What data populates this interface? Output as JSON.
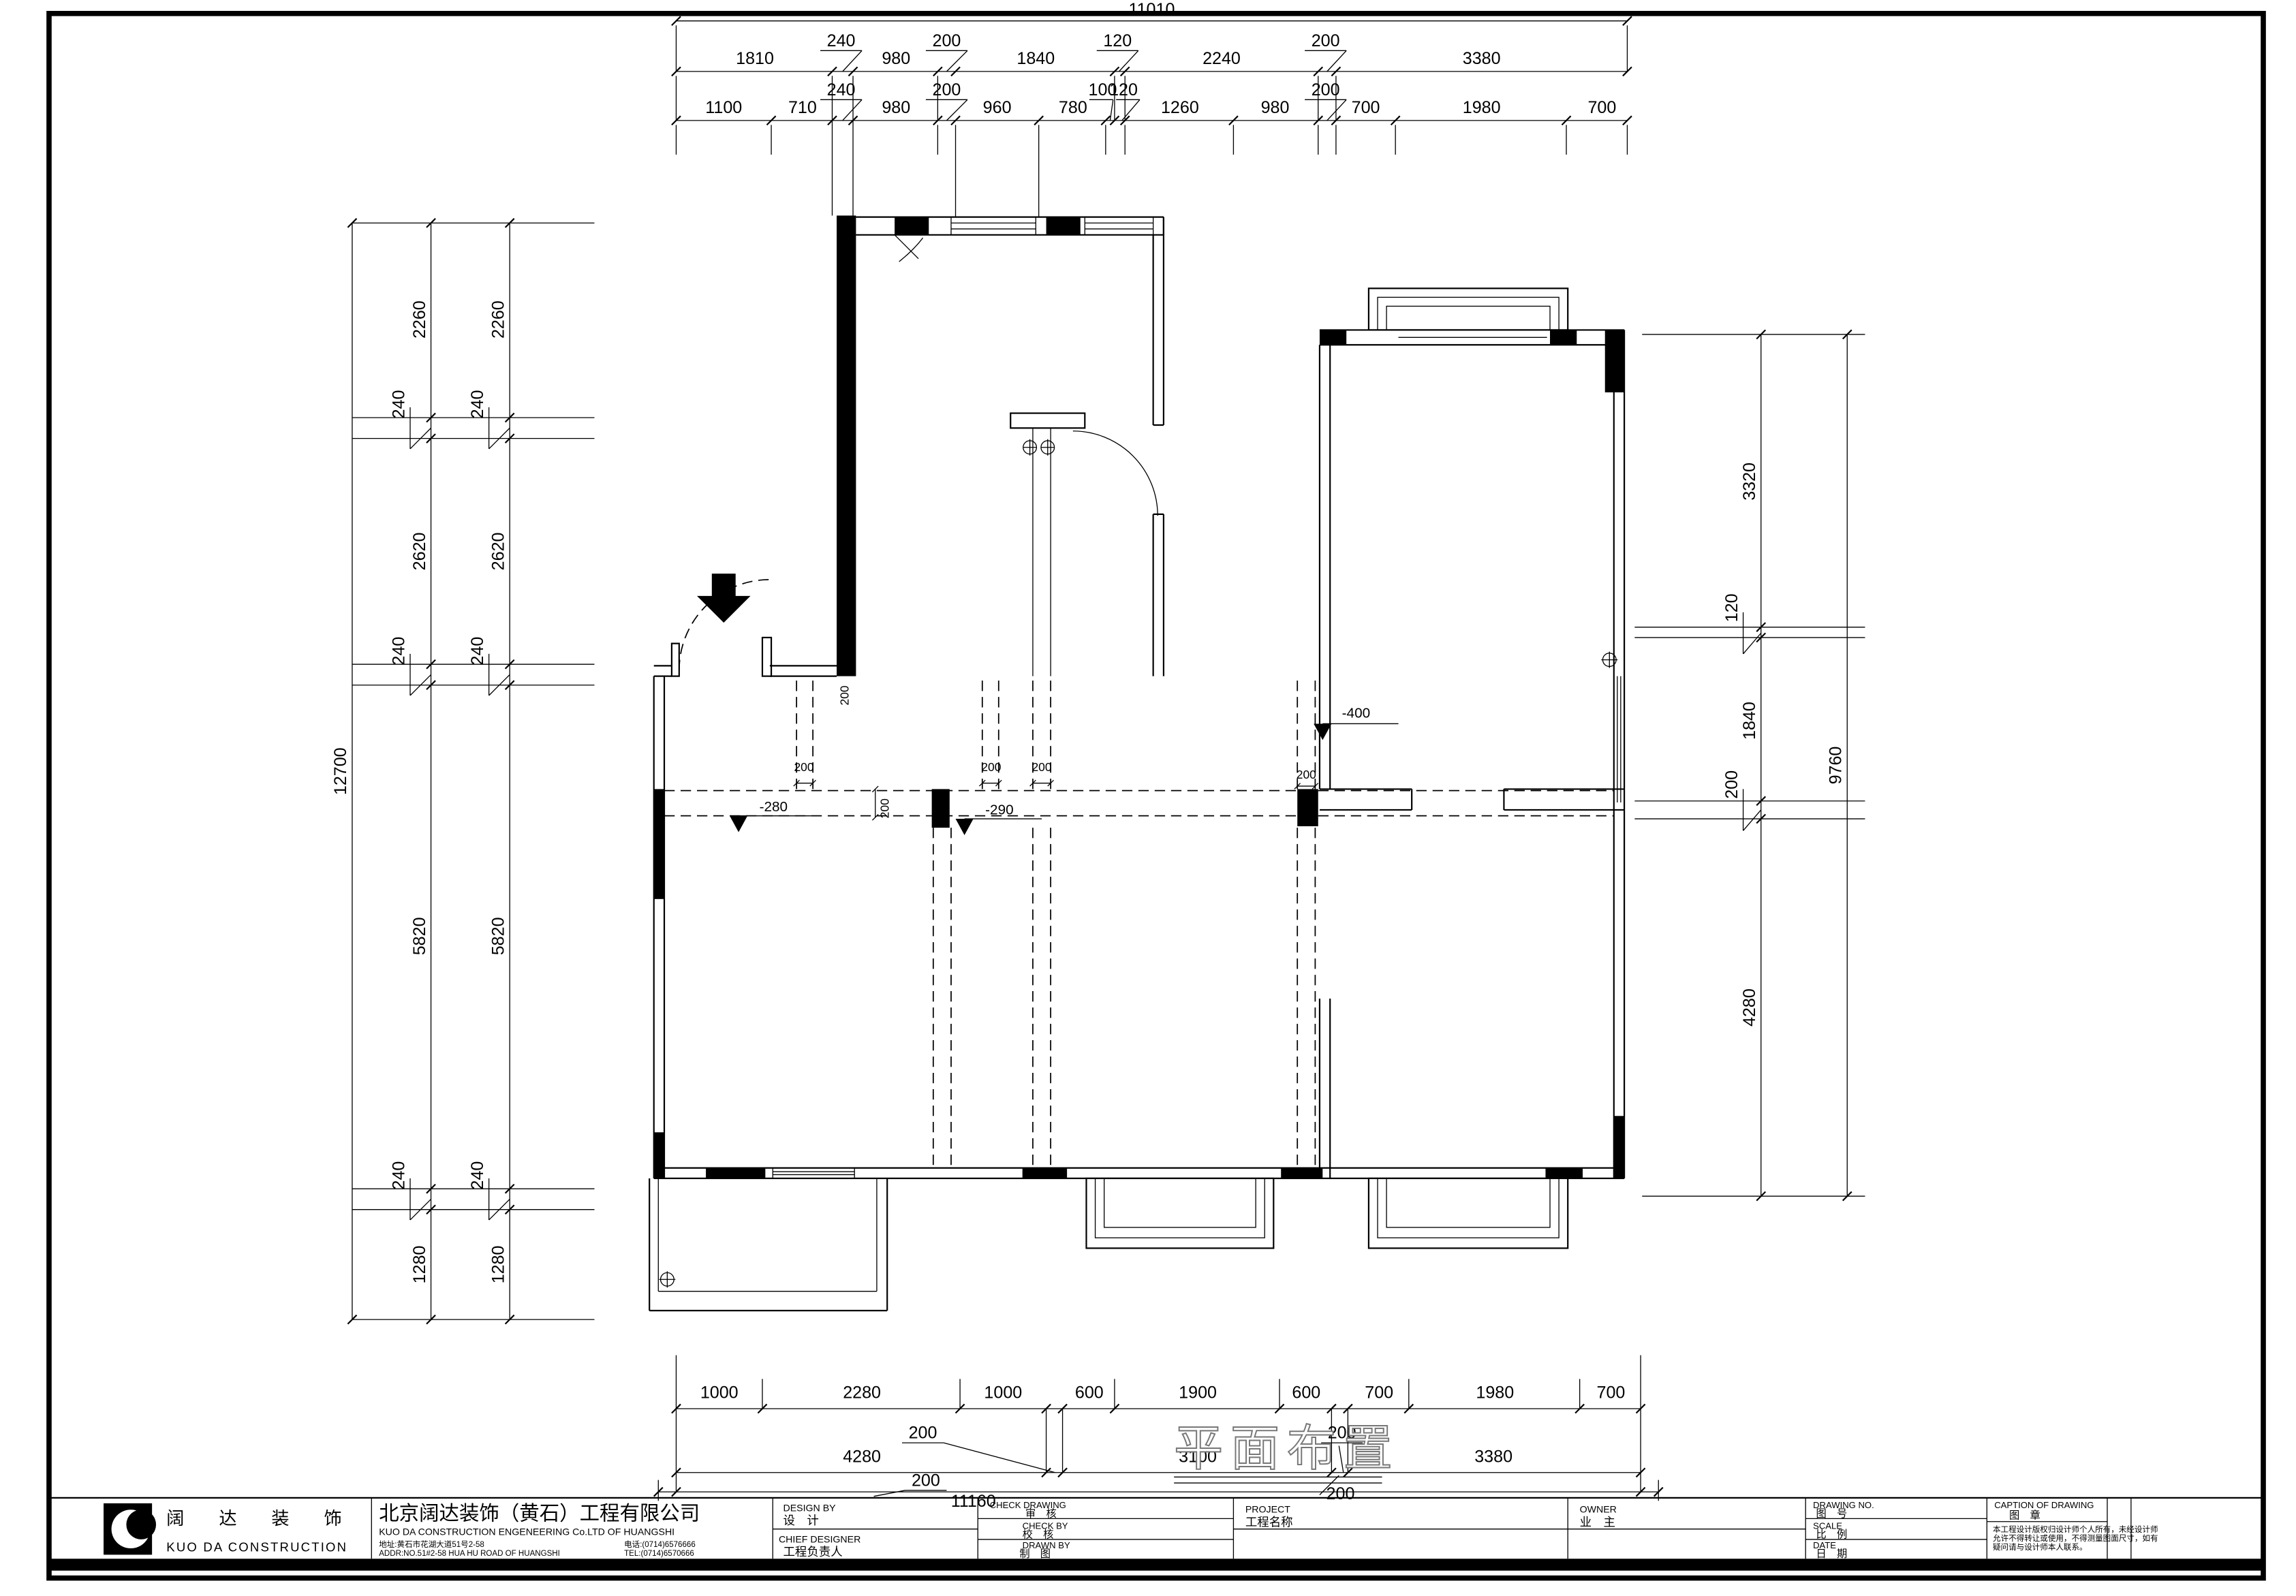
{
  "dims": {
    "top": {
      "total": "11010",
      "row1": [
        "1810",
        "240",
        "980",
        "200",
        "1840",
        "120",
        "2240",
        "200",
        "3380"
      ],
      "row2": [
        "1100",
        "710",
        "240",
        "980",
        "200",
        "960",
        "780",
        "100",
        "120",
        "1260",
        "980",
        "200",
        "700",
        "1980",
        "700"
      ]
    },
    "left": {
      "total": "12700",
      "inner": [
        "2260",
        "240",
        "2620",
        "240",
        "5820",
        "240",
        "1280"
      ],
      "outer": [
        "2260",
        "240",
        "2620",
        "240",
        "5820",
        "240",
        "1280"
      ]
    },
    "right": {
      "total": "9760",
      "segments": [
        "3320",
        "120",
        "1840",
        "200",
        "4280"
      ]
    },
    "bottom": {
      "row1": [
        "1000",
        "2280",
        "1000",
        "600",
        "1900",
        "600",
        "700",
        "1980",
        "700"
      ],
      "row2": [
        "4280",
        "200",
        "3100",
        "200",
        "3380"
      ],
      "row3": [
        "200",
        "11160",
        "200"
      ]
    }
  },
  "plan": {
    "caption": "平面布置",
    "levels": [
      "-280",
      "-290",
      "-400"
    ],
    "small_dims": [
      "200",
      "200",
      "200",
      "200",
      "200",
      "200"
    ]
  },
  "title_block": {
    "brand": {
      "name_cn": "阔  达  装  饰",
      "name_en": "KUO DA CONSTRUCTION"
    },
    "company": {
      "name": "北京阔达装饰（黄石）工程有限公司",
      "name_en": "KUO DA CONSTRUCTION ENGENEERING Co.LTD OF HUANGSHI",
      "address_cn": "地址:黄石市花湖大道51号2-58",
      "phone_cn": "电话:(0714)6576666",
      "address_en": "ADDR:NO.51#2-58 HUA HU ROAD OF HUANGSHI",
      "phone_en": "TEL:(0714)6570666"
    },
    "fields": {
      "design_by_en": "DESIGN BY",
      "design_by_cn": "设　计",
      "chief_designer_en": "CHIEF DESIGNER",
      "chief_designer_cn": "工程负责人",
      "check_drawing_en": "CHECK DRAWING",
      "check_drawing_cn": "审　核",
      "check_by_en": "CHECK BY",
      "check_by_cn": "校　核",
      "drawn_by_en": "DRAWN BY",
      "drawn_by_cn": "制　图",
      "project_en": "PROJECT",
      "project_cn": "工程名称",
      "owner_en": "OWNER",
      "owner_cn": "业　主",
      "drawing_no_en": "DRAWING NO.",
      "drawing_no_cn": "图　号",
      "scale_en": "SCALE",
      "scale_cn": "比　例",
      "date_en": "DATE",
      "date_cn": "日　期",
      "caption_en": "CAPTION OF DRAWING",
      "caption_cn": "图　章",
      "disclaimer_1": "本工程设计版权归设计师个人所有，未经设计师",
      "disclaimer_2": "允许不得转让或使用，不得测量图面尺寸，如有",
      "disclaimer_3": "疑问请与设计师本人联系。"
    }
  }
}
